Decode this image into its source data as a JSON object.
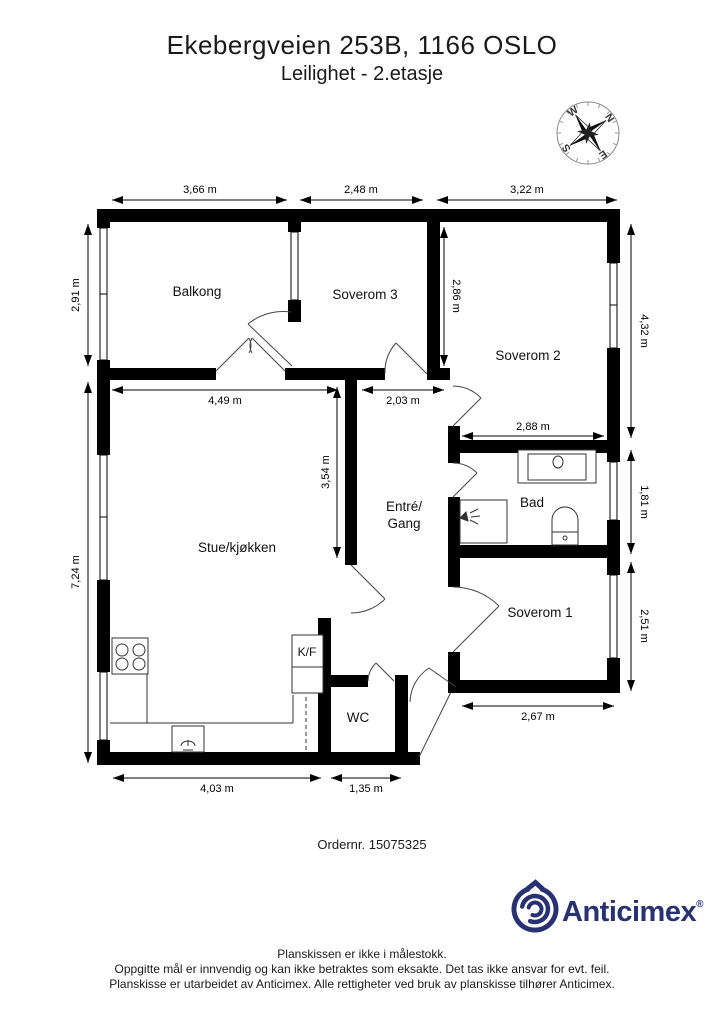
{
  "header": {
    "title": "Ekebergveien 253B, 1166 OSLO",
    "subtitle": "Leilighet  - 2.etasje"
  },
  "compass": {
    "n": "N",
    "e": "E",
    "s": "S",
    "w": "W"
  },
  "plan": {
    "rooms": {
      "balkong": "Balkong",
      "soverom3": "Soverom 3",
      "soverom2": "Soverom 2",
      "stue": "Stue/kjøkken",
      "entre_line1": "Entré/",
      "entre_line2": "Gang",
      "bad": "Bad",
      "soverom1": "Soverom 1",
      "wc": "WC",
      "kf": "K/F"
    },
    "dims": {
      "balkong_w": "3,66 m",
      "soverom3_w": "2,48 m",
      "soverom2_w": "3,22 m",
      "balkong_h": "2,91 m",
      "stue_h": "7,24 m",
      "soverom2_h": "4,32 m",
      "bad_h": "1,81 m",
      "soverom1_h": "2,51 m",
      "soverom3_h": "2,86 m",
      "stue_w": "4,49 m",
      "entre_w": "2,03 m",
      "entre_h": "3,54 m",
      "bad_w": "2,88 m",
      "soverom1_w": "2,67 m",
      "kitchen_w": "4,03 m",
      "wc_w": "1,35 m"
    }
  },
  "order": {
    "text": "Ordernr. 15075325"
  },
  "logo": {
    "name": "Anticimex",
    "registered": "®",
    "color": "#283272"
  },
  "footer": {
    "line1": "Planskissen er ikke i målestokk.",
    "line2": "Oppgitte mål er innvendig og kan ikke betraktes som eksakte. Det tas ikke ansvar for evt. feil.",
    "line3": "Planskisse er utarbeidet av Anticimex. Alle rettigheter ved bruk av planskisse tilhører Anticimex."
  }
}
